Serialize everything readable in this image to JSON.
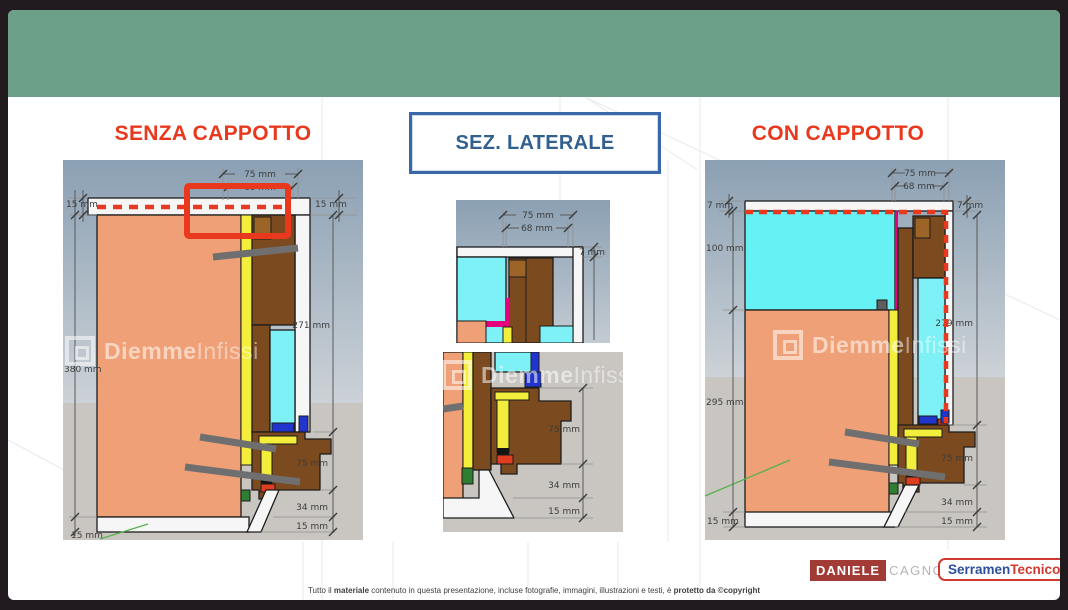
{
  "titles": {
    "left": "SENZA CAPPOTTO",
    "center": "SEZ. LATERALE",
    "right": "CON CAPPOTTO"
  },
  "watermark": {
    "brand_bold": "Diemme",
    "brand_light": "Infissi"
  },
  "left_diagram": {
    "dims": {
      "w75": "75 mm",
      "w68": "68 mm",
      "tl15": "15 mm",
      "tr15": "15 mm",
      "h380": "380 mm",
      "bl15": "15 mm",
      "h271": "271 mm",
      "h75": "75 mm",
      "h34": "34 mm",
      "h15": "15 mm"
    }
  },
  "center_top_diagram": {
    "dims": {
      "w75": "75 mm",
      "w68": "68 mm",
      "t7": "7 mm"
    }
  },
  "center_bottom_diagram": {
    "dims": {
      "h75": "75 mm",
      "h34": "34 mm",
      "h15": "15 mm"
    }
  },
  "right_diagram": {
    "dims": {
      "w75": "75 mm",
      "w68": "68 mm",
      "l7": "7 mm",
      "r7": "7 mm",
      "h100": "100 mm",
      "h295": "295 mm",
      "bl15": "15 mm",
      "h279": "279 mm",
      "h75": "75 mm",
      "h34": "34 mm",
      "h15": "15 mm"
    }
  },
  "footer": {
    "logo_daniele": {
      "first": "DANIELE",
      "last": "CAGNONI"
    },
    "logo_serramentecnico": {
      "part1": "Serramen",
      "part2": "Tecnico"
    },
    "copyright_prefix": "Tutto il ",
    "copyright_bold1": "materiale",
    "copyright_mid": " contenuto in questa presentazione, incluse fotografie, immagini, illustrazioni e testi, è ",
    "copyright_bold2": "protetto da ©copyright"
  },
  "colors": {
    "header_bar": "#6b9f87",
    "title_red": "#e8391f",
    "title_blue": "#33618f",
    "highlight_red": "#e8391f",
    "wall": "#efa077",
    "insulation_cyan": "#7df1f5",
    "frame_brown": "#7b4a1f",
    "foam_yellow": "#f2ee3b"
  }
}
